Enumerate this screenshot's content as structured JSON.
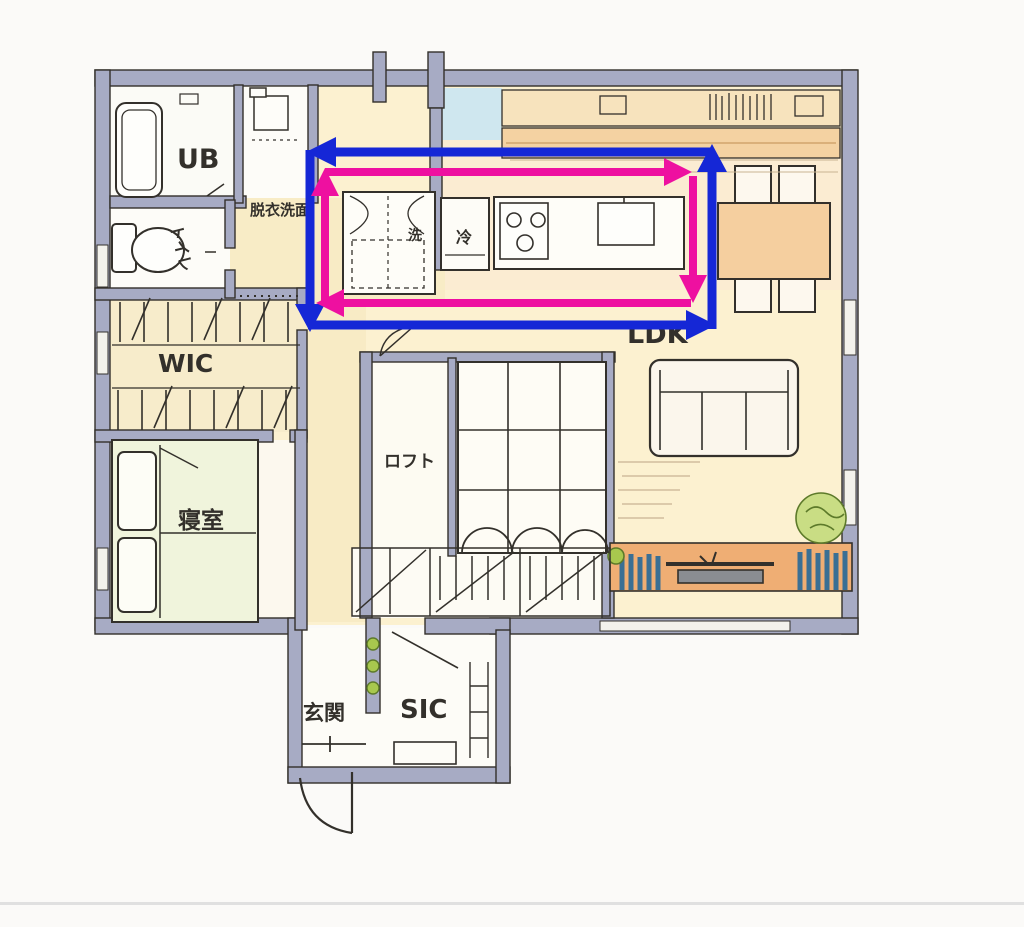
{
  "colors": {
    "wall": "#a7abc4",
    "ink": "#33302b",
    "ink_light": "#6b655c",
    "blue_arrow": "#1527d6",
    "magenta_arrow": "#ee10a0",
    "floor_cream": "#f8ecc6",
    "floor_ldk": "#fcf1d0",
    "floor_kitchen": "#fbecd2",
    "floor_white": "#fdfbf3",
    "counter_orange": "#efae74",
    "counter_light": "#f4d2a2",
    "shelf_cream": "#f7e3bd",
    "table_wood": "#f5cf9f",
    "bed_green": "#f0f4dc",
    "plant_green": "#a8c84e",
    "plant_dark": "#5d7a2a",
    "books_blue": "#3a6f94",
    "tile_blue": "#cfe7ef",
    "pencil": "#c9b492",
    "divider_gray": "#e0e0e0"
  },
  "rooms": {
    "ub": {
      "label": "UB"
    },
    "toilet": {
      "label": "トイレ"
    },
    "washroom": {
      "label": "脱衣洗面"
    },
    "washer": {
      "label": "洗"
    },
    "fridge": {
      "label": "冷"
    },
    "wic": {
      "label": "WIC"
    },
    "bedroom": {
      "label": "寝室"
    },
    "loft": {
      "label": "ロフト"
    },
    "ldk": {
      "label": "LDK"
    },
    "entrance": {
      "label": "玄関"
    },
    "sic": {
      "label": "SIC"
    }
  }
}
